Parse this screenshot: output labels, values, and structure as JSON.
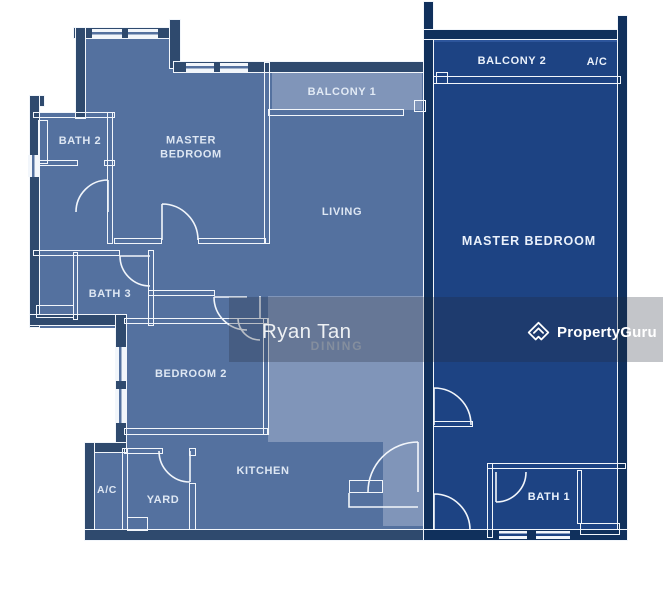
{
  "page": {
    "type": "residential floor plan"
  },
  "units": {
    "unit_a": {
      "rooms": {
        "master_bedroom": {
          "label": "MASTER BEDROOM"
        },
        "bath2": {
          "label": "BATH 2"
        },
        "bath3": {
          "label": "BATH 3"
        },
        "balcony1": {
          "label": "BALCONY 1"
        },
        "living": {
          "label": "LIVING"
        },
        "dining": {
          "label": "DINING"
        },
        "bedroom2": {
          "label": "BEDROOM 2"
        },
        "kitchen": {
          "label": "KITCHEN"
        },
        "yard": {
          "label": "YARD"
        },
        "ac": {
          "label": "A/C"
        }
      }
    },
    "unit_b": {
      "rooms": {
        "balcony2": {
          "label": "BALCONY 2"
        },
        "ac": {
          "label": "A/C"
        },
        "master_bedroom": {
          "label": "MASTER BEDROOM"
        },
        "bath1": {
          "label": "BATH 1"
        }
      }
    }
  },
  "watermark": {
    "agent": "Ryan Tan",
    "brand": "PropertyGuru",
    "brand_icon": "propertyguru-house-icon"
  },
  "colors": {
    "page_bg": "#ffffff",
    "unit_a_fill": "#54719f",
    "unit_a_highlight": "#8095b9",
    "unit_b_fill": "#1d4383",
    "unit_b_top_strip": "#2d559b",
    "wall_dark_a": "#2f4a6e",
    "wall_dark_b": "#10305c",
    "wall_white": "#f2f6fb",
    "label_light": "rgba(232,240,250,0.93)",
    "label_dark_unit": "#eaf1fb",
    "dining_label": "#a9b4c4",
    "watermark_overlay": "rgba(33,40,54,0.27)",
    "watermark_text": "#eef1f4",
    "brand_white": "#ffffff"
  }
}
